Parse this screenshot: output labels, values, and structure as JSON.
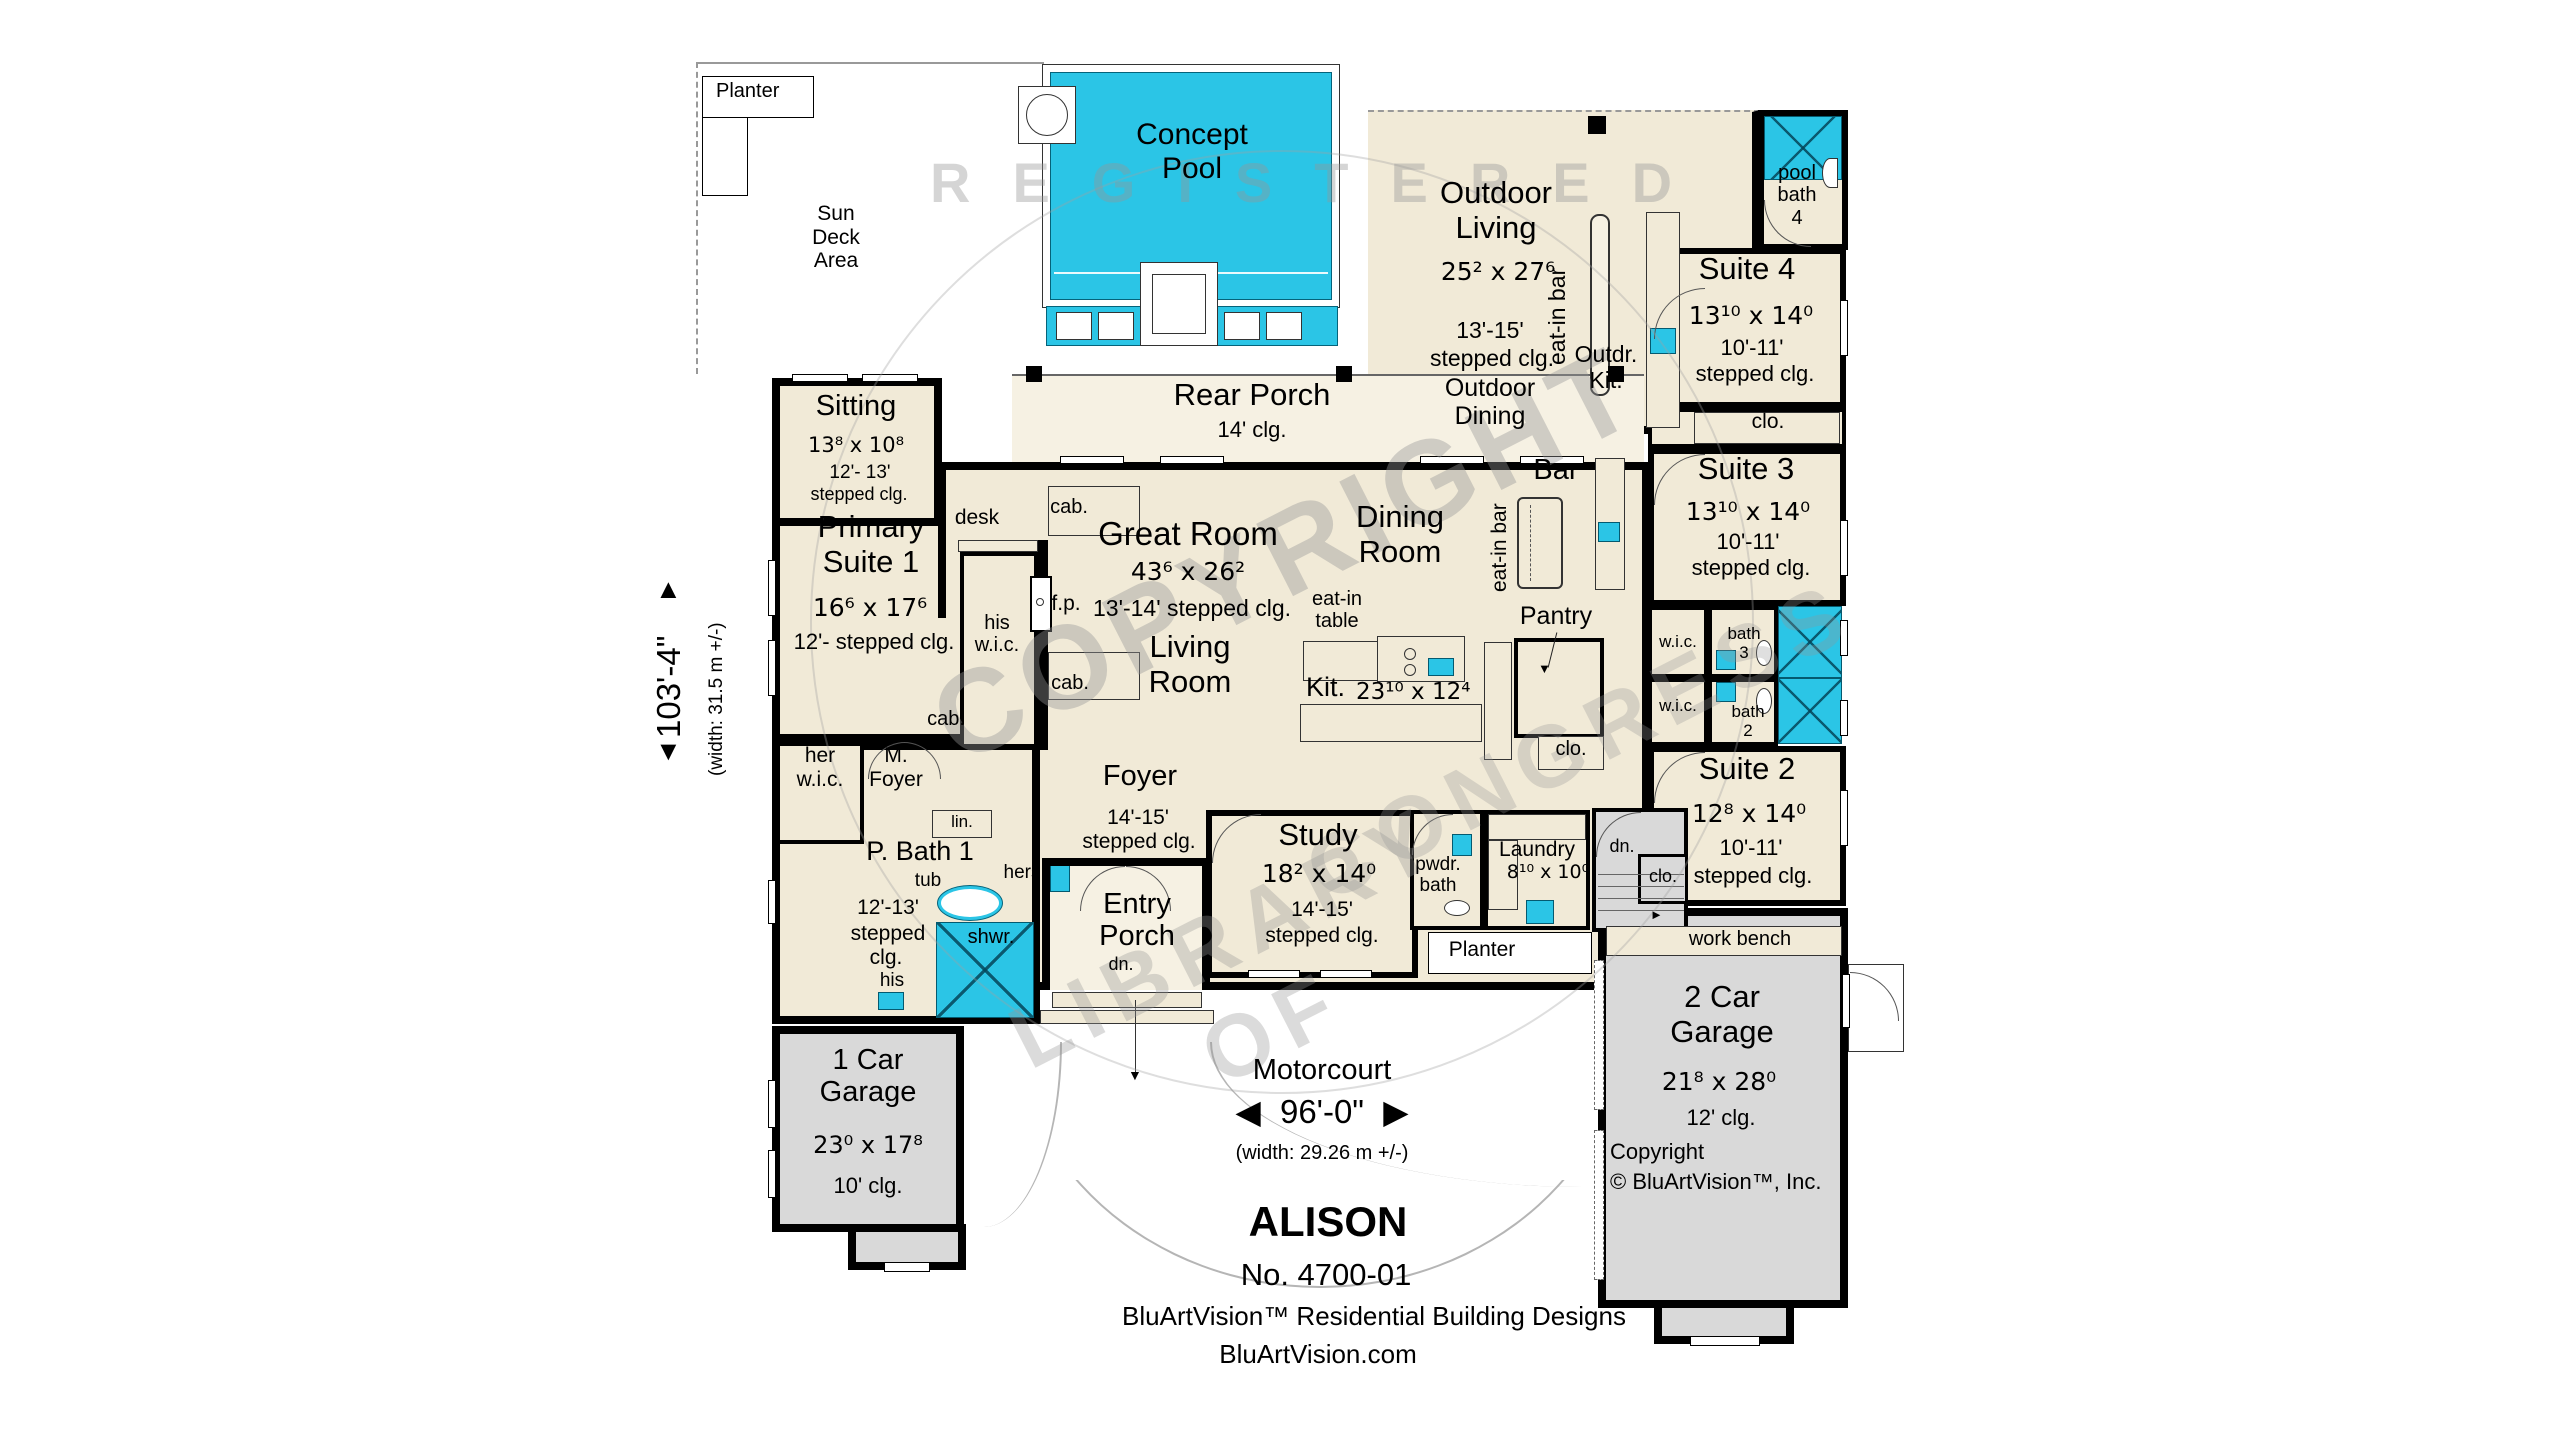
{
  "colors": {
    "water": "#2bc5e6",
    "room_fill": "#f1ead7",
    "porch_fill": "#f6f1e3",
    "garage_fill": "#d9d9d9",
    "wall": "#000000",
    "watermark_gray": "#969696"
  },
  "watermark": {
    "arc_top": "REGISTERED",
    "center": "COPYRIGHT",
    "bottom_left": "LIBRARY OF",
    "bottom_right": "CONGRESS"
  },
  "dim_left": {
    "arrow_up": "▲",
    "value": "103'-4\"",
    "metric": "(width: 31.5 m +/-)",
    "arrow_down": "▼"
  },
  "motorcourt": {
    "label": "Motorcourt",
    "arrow_left": "◀",
    "value": "96'-0\"",
    "arrow_right": "▶",
    "metric": "(width: 29.26 m +/-)"
  },
  "title_block": {
    "name": "ALISON",
    "number": "No. 4700-01",
    "company": "BluArtVision™ Residential Building Designs",
    "website": "BluArtVision.com"
  },
  "outdoor": {
    "planter_top": "Planter",
    "sun_deck": [
      "Sun",
      "Deck",
      "Area"
    ],
    "pool": [
      "Concept",
      "Pool"
    ],
    "living": {
      "name": [
        "Outdoor",
        "Living"
      ],
      "dims": "25² x 27⁶",
      "clg1": "13'-15'",
      "clg2": "stepped clg.",
      "dining": [
        "Outdoor",
        "Dining"
      ]
    },
    "eat_in_bar": "eat-in bar",
    "kitchen": [
      "Outdr.",
      "Kit."
    ]
  },
  "rooms": {
    "pool_bath": {
      "line1": "pool",
      "line2": "bath",
      "number": "4"
    },
    "suite4": {
      "name": "Suite 4",
      "dims": "13¹⁰ x 14⁰",
      "clg1": "10'-11'",
      "clg2": "stepped clg.",
      "closet": "clo."
    },
    "suite3": {
      "name": "Suite 3",
      "dims": "13¹⁰ x 14⁰",
      "clg1": "10'-11'",
      "clg2": "stepped clg."
    },
    "suite2": {
      "name": "Suite 2",
      "dims": "12⁸ x 14⁰",
      "clg1": "10'-11'",
      "clg2": "stepped clg."
    },
    "wic3": "w.i.c.",
    "bath3": {
      "line1": "bath",
      "number": "3"
    },
    "wic2": "w.i.c.",
    "bath2": {
      "line1": "bath",
      "number": "2"
    },
    "rear_porch": {
      "name": "Rear Porch",
      "clg": "14' clg."
    },
    "sitting": {
      "name": "Sitting",
      "dims": "13⁸ x 10⁸",
      "clg1": "12'- 13'",
      "clg2": "stepped clg."
    },
    "primary": {
      "name": [
        "Primary",
        "Suite 1"
      ],
      "dims": "16⁶ x 17⁶",
      "clg": "12'- stepped clg."
    },
    "his_wic": [
      "his",
      "w.i.c."
    ],
    "her_wic": [
      "her",
      "w.i.c."
    ],
    "m_foyer": [
      "M.",
      "Foyer"
    ],
    "p_bath": {
      "name": "P. Bath 1",
      "clg1": "12'-13'",
      "clg2": "stepped",
      "clg3": "clg."
    },
    "great_room": {
      "name": "Great Room",
      "dims": "43⁶ x 26²",
      "clg": "13'-14' stepped clg."
    },
    "living_room": [
      "Living",
      "Room"
    ],
    "dining_room": [
      "Dining",
      "Room"
    ],
    "kitchen": {
      "name": "Kit.",
      "dims": "23¹⁰ x 12⁴"
    },
    "bar": {
      "name": "Bar",
      "eat_in": "eat-in bar"
    },
    "pantry": {
      "name": "Pantry",
      "closet": "clo."
    },
    "foyer": {
      "name": "Foyer",
      "clg1": "14'-15'",
      "clg2": "stepped clg."
    },
    "study": {
      "name": "Study",
      "dims": "18² x 14⁰",
      "clg1": "14'-15'",
      "clg2": "stepped clg."
    },
    "entry_porch": {
      "name": [
        "Entry",
        "Porch"
      ],
      "dn": "dn."
    },
    "powder": [
      "pwdr.",
      "bath"
    ],
    "laundry": {
      "name": "Laundry",
      "dims": "8¹⁰ x 10⁰"
    },
    "stairs": {
      "dn": "dn.",
      "closet": "clo."
    },
    "planter_bottom": "Planter",
    "garage2": {
      "name": [
        "2 Car",
        "Garage"
      ],
      "dims": "21⁸ x 28⁰",
      "clg": "12' clg.",
      "copyright1": "Copyright",
      "copyright2": "© BluArtVision™, Inc.",
      "work_bench": "work bench"
    },
    "garage1": {
      "name": [
        "1 Car",
        "Garage"
      ],
      "dims": "23⁰ x 17⁸",
      "clg": "10' clg."
    }
  },
  "fixtures": {
    "desk": "desk",
    "cab": "cab.",
    "fp": "f.p.",
    "linen": "lin.",
    "tub": "tub",
    "hers": "hers",
    "his": "his",
    "shower": "shwr.",
    "eat_in_table": [
      "eat-in",
      "table"
    ]
  },
  "icons": {
    "stair_arrow": "►",
    "entry_arrow": "▼",
    "pantry_arrow": "▼"
  }
}
